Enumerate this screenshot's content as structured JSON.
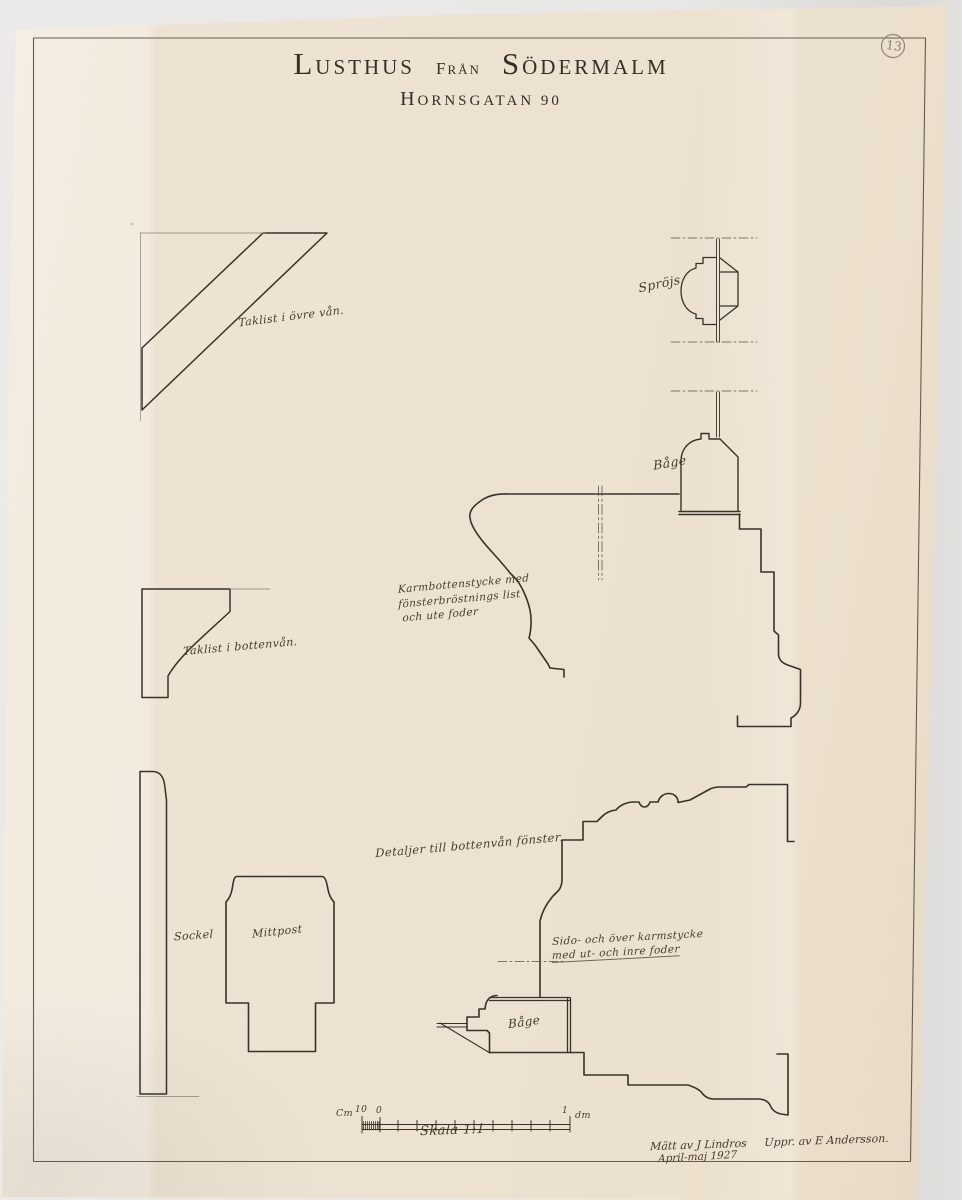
{
  "sheet": {
    "number": "13",
    "title": {
      "word1": "Lusthus",
      "word2": "från",
      "word3": "Södermalm"
    },
    "subtitle": "Hornsgatan 90"
  },
  "annotations": {
    "taklist_ovre": "Taklist i övre vån.",
    "sprojs": "Spröjs",
    "bage_ovre": "Båge",
    "karmbotten_line1": "Karmbottenstycke med",
    "karmbotten_line2": "fönsterbröstnings list",
    "karmbotten_line3": "och ute foder",
    "taklist_botten": "Taklist i bottenvån.",
    "detaljer": "Detaljer till bottenvån fönster.",
    "sockel": "Sockel",
    "mittpost": "Mittpost",
    "sidokarm_line1": "Sido- och över karmstycke",
    "sidokarm_line2": "med ut- och inre foder",
    "bage_nedre": "Båge"
  },
  "scale_bar": {
    "unit_left": "Cm",
    "tick_left": "10",
    "tick_zero": "0",
    "tick_right": "1",
    "unit_right": "dm",
    "caption": "Skala 1:1"
  },
  "signature": {
    "measured": "Mätt av J Lindros",
    "drawn": "Uppr. av E Andersson.",
    "date": "April-maj 1927"
  },
  "colors": {
    "paper": "#ede2d1",
    "ink": "#37322a",
    "thin_line": "#857a6d",
    "pencil": "#8a7e6e",
    "background": "#e9e8e6"
  }
}
